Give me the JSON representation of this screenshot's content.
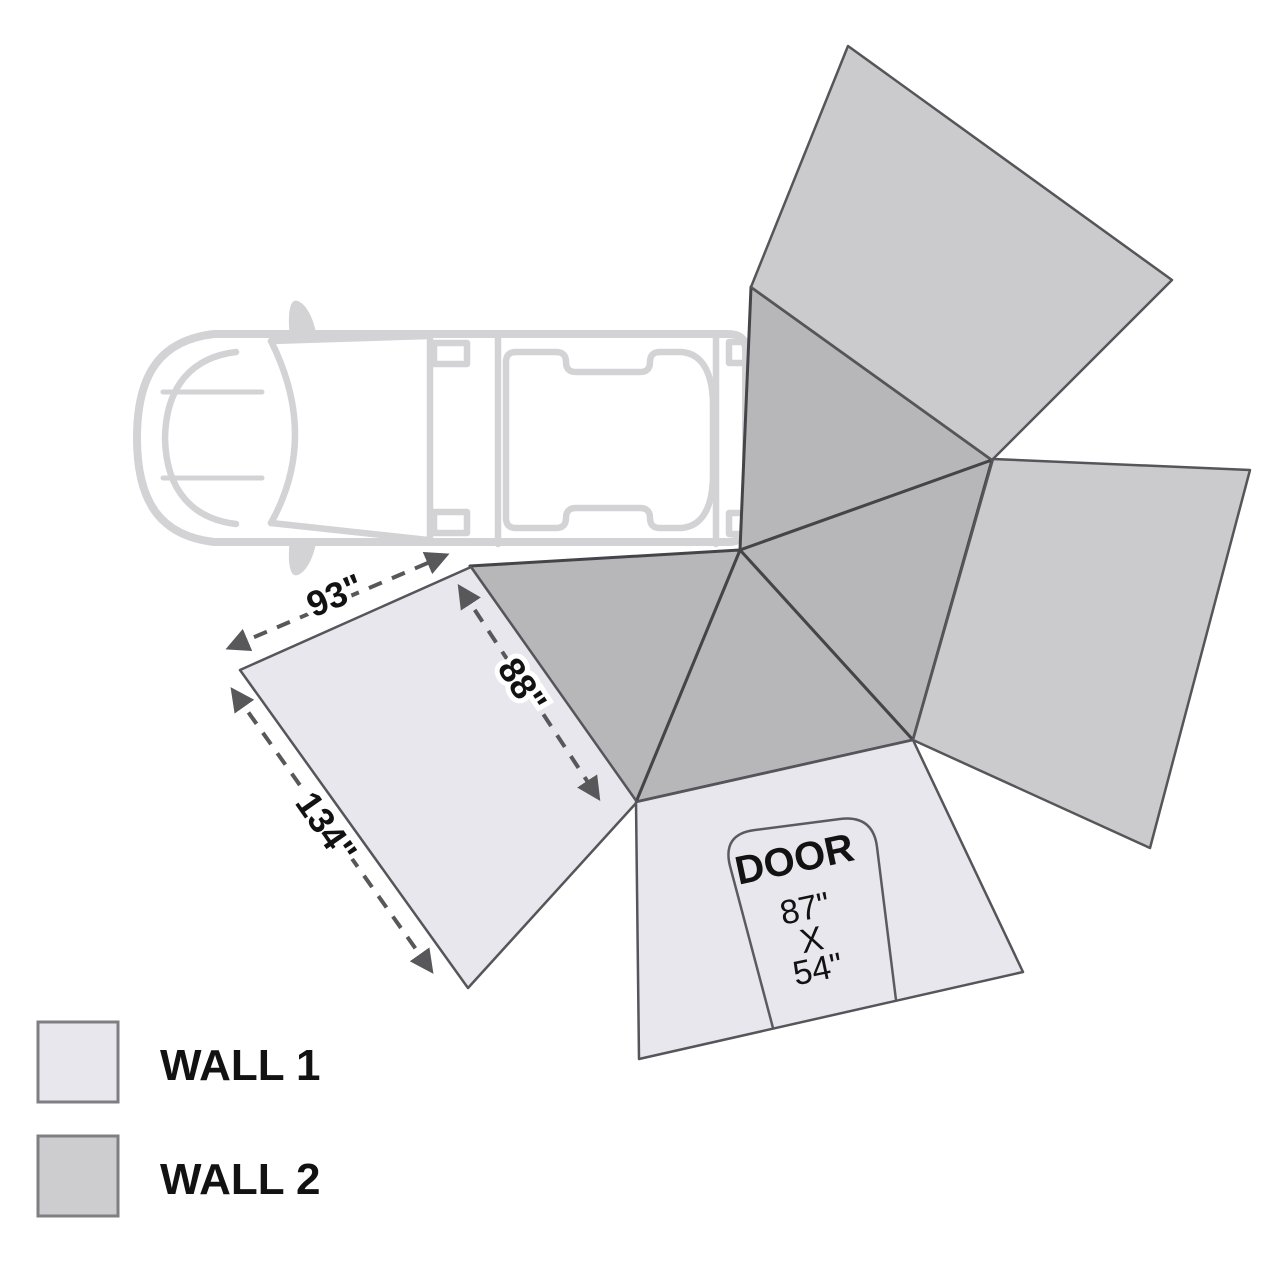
{
  "diagram": {
    "title": "awning-walls-layout",
    "colors": {
      "background": "#ffffff",
      "wall1": "#e7e7ed",
      "wall2": "#cbcbce",
      "roof": "#b7b7ba",
      "truck_outline": "#d3d3d6",
      "dimension": "#58585b",
      "text": "#121212"
    },
    "panels": {
      "wall1_left": {
        "points": "240,670 471,567 637,802 468,988"
      },
      "wall1_door": {
        "points": "636,802 913,740 1023,972 639,1059"
      },
      "wall2_top": {
        "points": "751,287 848,46 1172,280 992,460"
      },
      "wall2_right": {
        "points": "993,459 1250,470 1150,848 913,740"
      },
      "roof_top": {
        "points": "751,287 992,460 740,550"
      },
      "roof_right": {
        "points": "740,550 992,460 913,740"
      },
      "roof_mid": {
        "points": "740,550 913,740 636,802"
      },
      "roof_left": {
        "points": "470,566 740,550 636,802"
      }
    },
    "door": {
      "outline_path": "M 773 1028 L 730 866 Q 722 834 755 830 L 840 819 Q 873 815 877 847 L 896 1000",
      "label": "DOOR",
      "size_lines": [
        "87\"",
        "X",
        "54\""
      ]
    },
    "dimensions": [
      {
        "label": "93\"",
        "x1": 231,
        "y1": 647,
        "x2": 444,
        "y2": 556
      },
      {
        "label": "88\"",
        "x1": 461,
        "y1": 589,
        "x2": 597,
        "y2": 796
      },
      {
        "label": "134\"",
        "x1": 234,
        "y1": 692,
        "x2": 430,
        "y2": 969
      }
    ],
    "legend": {
      "items": [
        {
          "label": "WALL 1",
          "color": "#e7e7ed"
        },
        {
          "label": "WALL 2",
          "color": "#cdcdd0"
        }
      ]
    }
  }
}
